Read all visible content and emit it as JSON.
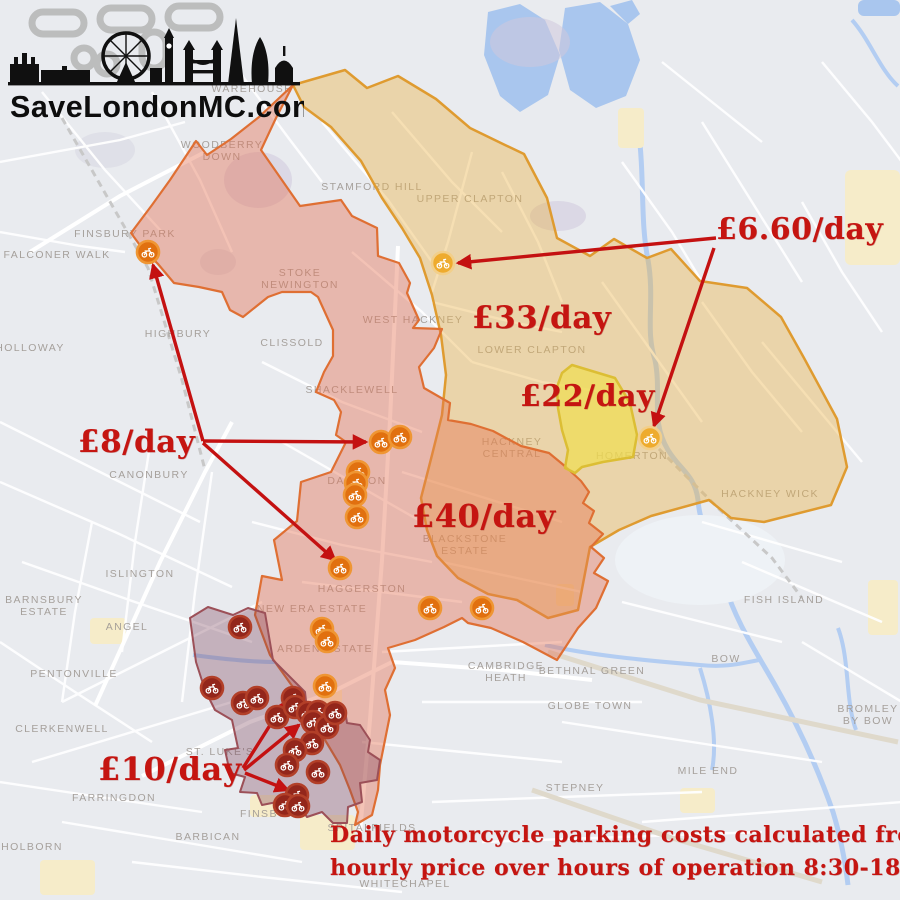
{
  "logo": {
    "text": "SaveLondonMC.com"
  },
  "annotations": {
    "red_labels": [
      {
        "id": "price-660",
        "text": "£6.60/day",
        "x": 716,
        "y": 212,
        "size": 30
      },
      {
        "id": "price-33",
        "text": "£33/day",
        "x": 472,
        "y": 300,
        "size": 31
      },
      {
        "id": "price-22",
        "text": "£22/day",
        "x": 520,
        "y": 379,
        "size": 30
      },
      {
        "id": "price-40",
        "text": "£40/day",
        "x": 412,
        "y": 497,
        "size": 32
      },
      {
        "id": "price-8",
        "text": "£8/day",
        "x": 78,
        "y": 424,
        "size": 31
      },
      {
        "id": "price-10",
        "text": "£10/day",
        "x": 98,
        "y": 750,
        "size": 32
      },
      {
        "id": "caption-line-1",
        "text": "Daily motorcycle parking costs calculated from",
        "x": 330,
        "y": 822,
        "size": 22
      },
      {
        "id": "caption-line-2",
        "text": "hourly price over hours of operation 8:30-18:30",
        "x": 330,
        "y": 855,
        "size": 22
      }
    ]
  },
  "map": {
    "zones": [
      {
        "id": "z33",
        "price": "£33/day",
        "fill": "rgba(235,178,68,0.40)",
        "stroke": "#df9b30"
      },
      {
        "id": "z40",
        "price": "£40/day",
        "fill": "rgba(228,112,80,0.42)",
        "stroke": "#df6f33"
      },
      {
        "id": "z22",
        "price": "£22/day",
        "fill": "rgba(240,222,80,0.70)",
        "stroke": "#dcbe34"
      },
      {
        "id": "z10",
        "price": "£10/day",
        "fill": "rgba(120,62,86,0.33)",
        "stroke": "#9c5058"
      }
    ],
    "marker_styles": {
      "dark": {
        "fill": "#93261b",
        "stroke": "#b23f28"
      },
      "orange": {
        "fill": "#e1700f",
        "stroke": "#ef9633"
      },
      "amber": {
        "fill": "#eeab2e",
        "stroke": "#f2cf8a"
      }
    },
    "markers": [
      {
        "x": 443,
        "y": 263,
        "type": "amber"
      },
      {
        "x": 650,
        "y": 438,
        "type": "amber"
      },
      {
        "x": 148,
        "y": 252,
        "type": "orange"
      },
      {
        "x": 381,
        "y": 442,
        "type": "orange"
      },
      {
        "x": 400,
        "y": 437,
        "type": "orange"
      },
      {
        "x": 358,
        "y": 472,
        "type": "orange"
      },
      {
        "x": 356,
        "y": 483,
        "type": "orange"
      },
      {
        "x": 355,
        "y": 495,
        "type": "orange"
      },
      {
        "x": 357,
        "y": 517,
        "type": "orange"
      },
      {
        "x": 340,
        "y": 568,
        "type": "orange"
      },
      {
        "x": 430,
        "y": 608,
        "type": "orange"
      },
      {
        "x": 482,
        "y": 608,
        "type": "orange"
      },
      {
        "x": 322,
        "y": 629,
        "type": "orange"
      },
      {
        "x": 327,
        "y": 641,
        "type": "orange"
      },
      {
        "x": 325,
        "y": 686,
        "type": "orange"
      },
      {
        "x": 240,
        "y": 627,
        "type": "dark"
      },
      {
        "x": 212,
        "y": 688,
        "type": "dark"
      },
      {
        "x": 243,
        "y": 703,
        "type": "dark"
      },
      {
        "x": 257,
        "y": 698,
        "type": "dark"
      },
      {
        "x": 277,
        "y": 717,
        "type": "dark"
      },
      {
        "x": 293,
        "y": 698,
        "type": "dark"
      },
      {
        "x": 295,
        "y": 707,
        "type": "dark"
      },
      {
        "x": 308,
        "y": 713,
        "type": "dark"
      },
      {
        "x": 318,
        "y": 712,
        "type": "dark"
      },
      {
        "x": 313,
        "y": 722,
        "type": "dark"
      },
      {
        "x": 327,
        "y": 727,
        "type": "dark"
      },
      {
        "x": 335,
        "y": 713,
        "type": "dark"
      },
      {
        "x": 312,
        "y": 743,
        "type": "dark"
      },
      {
        "x": 295,
        "y": 750,
        "type": "dark"
      },
      {
        "x": 287,
        "y": 765,
        "type": "dark"
      },
      {
        "x": 318,
        "y": 772,
        "type": "dark"
      },
      {
        "x": 297,
        "y": 795,
        "type": "dark"
      },
      {
        "x": 285,
        "y": 805,
        "type": "dark"
      },
      {
        "x": 298,
        "y": 806,
        "type": "dark"
      }
    ],
    "arrows": [
      {
        "x1": 716,
        "y1": 238,
        "x2": 458,
        "y2": 263
      },
      {
        "x1": 714,
        "y1": 248,
        "x2": 654,
        "y2": 426
      },
      {
        "x1": 203,
        "y1": 441,
        "x2": 153,
        "y2": 265
      },
      {
        "x1": 203,
        "y1": 441,
        "x2": 366,
        "y2": 442
      },
      {
        "x1": 203,
        "y1": 443,
        "x2": 335,
        "y2": 560
      },
      {
        "x1": 243,
        "y1": 768,
        "x2": 284,
        "y2": 703
      },
      {
        "x1": 244,
        "y1": 770,
        "x2": 299,
        "y2": 725
      },
      {
        "x1": 245,
        "y1": 773,
        "x2": 288,
        "y2": 790
      }
    ],
    "place_labels": [
      {
        "text": "WAREHOUSE",
        "x": 252,
        "y": 92
      },
      {
        "lines": [
          "WOODBERRY",
          "DOWN"
        ],
        "x": 222,
        "y": 148
      },
      {
        "text": "STAMFORD HILL",
        "x": 372,
        "y": 190
      },
      {
        "text": "UPPER CLAPTON",
        "x": 470,
        "y": 202
      },
      {
        "text": "FINSBURY PARK",
        "x": 125,
        "y": 237
      },
      {
        "text": "FALCONER WALK",
        "x": 57,
        "y": 258
      },
      {
        "lines": [
          "STOKE",
          "NEWINGTON"
        ],
        "x": 300,
        "y": 276
      },
      {
        "text": "WEST HACKNEY",
        "x": 413,
        "y": 323
      },
      {
        "text": "HOLLOWAY",
        "x": 30,
        "y": 351
      },
      {
        "text": "HIGHBURY",
        "x": 178,
        "y": 337
      },
      {
        "text": "CLISSOLD",
        "x": 292,
        "y": 346
      },
      {
        "text": "LOWER CLAPTON",
        "x": 532,
        "y": 353
      },
      {
        "text": "SHACKLEWELL",
        "x": 352,
        "y": 393
      },
      {
        "lines": [
          "HACKNEY",
          "CENTRAL"
        ],
        "x": 512,
        "y": 445
      },
      {
        "text": "HOMERTON",
        "x": 632,
        "y": 459
      },
      {
        "text": "CANONBURY",
        "x": 149,
        "y": 478
      },
      {
        "text": "DALSTON",
        "x": 357,
        "y": 484
      },
      {
        "text": "HACKNEY WICK",
        "x": 770,
        "y": 497
      },
      {
        "lines": [
          "BLACKSTONE",
          "ESTATE"
        ],
        "x": 465,
        "y": 542
      },
      {
        "text": "ISLINGTON",
        "x": 140,
        "y": 577
      },
      {
        "text": "HAGGERSTON",
        "x": 362,
        "y": 592
      },
      {
        "lines": [
          "BARNSBURY",
          "ESTATE"
        ],
        "x": 44,
        "y": 603
      },
      {
        "text": "FISH ISLAND",
        "x": 784,
        "y": 603
      },
      {
        "text": "NEW ERA ESTATE",
        "x": 312,
        "y": 612
      },
      {
        "text": "ANGEL",
        "x": 127,
        "y": 630
      },
      {
        "text": "ARDEN ESTATE",
        "x": 325,
        "y": 652
      },
      {
        "text": "BOW",
        "x": 726,
        "y": 662
      },
      {
        "lines": [
          "CAMBRIDGE",
          "HEATH"
        ],
        "x": 506,
        "y": 669
      },
      {
        "text": "BETHNAL GREEN",
        "x": 592,
        "y": 674
      },
      {
        "text": "PENTONVILLE",
        "x": 74,
        "y": 677
      },
      {
        "text": "GLOBE TOWN",
        "x": 590,
        "y": 709
      },
      {
        "lines": [
          "BROMLEY",
          "BY BOW"
        ],
        "x": 868,
        "y": 712
      },
      {
        "text": "CLERKENWELL",
        "x": 62,
        "y": 732
      },
      {
        "text": "ST. LUKE'S",
        "x": 220,
        "y": 755
      },
      {
        "text": "MILE END",
        "x": 708,
        "y": 774
      },
      {
        "text": "STEPNEY",
        "x": 575,
        "y": 791
      },
      {
        "text": "FARRINGDON",
        "x": 114,
        "y": 801
      },
      {
        "text": "FINSBURY",
        "x": 272,
        "y": 817
      },
      {
        "text": "SPITALFIELDS",
        "x": 372,
        "y": 831
      },
      {
        "text": "BARBICAN",
        "x": 208,
        "y": 840
      },
      {
        "text": "HOLBORN",
        "x": 32,
        "y": 850
      },
      {
        "text": "WHITECHAPEL",
        "x": 405,
        "y": 887
      }
    ]
  },
  "colors": {
    "accent_red": "#c41111",
    "map_background": "#e9ebef",
    "water": "#a9c6ee",
    "logo_black": "#101010",
    "chain_gray": "#b5b5b5"
  }
}
